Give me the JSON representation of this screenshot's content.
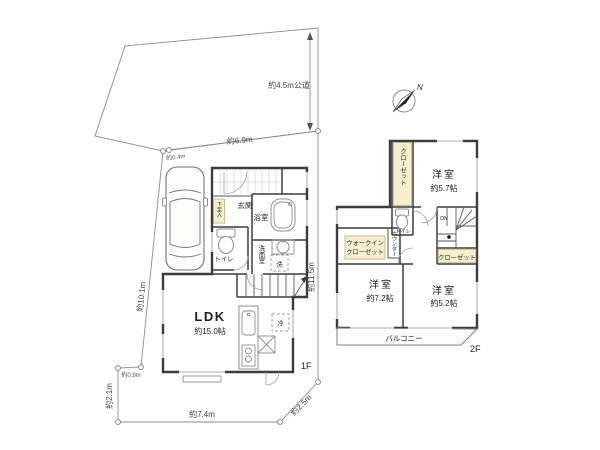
{
  "site": {
    "road_label": "約4.5m公道",
    "compass_n": "N",
    "dims": {
      "top": "約6.9m",
      "top_jog": "約0.4m",
      "left": "約10.1m",
      "bottom_jog": "約0.9m",
      "lower_left": "約2.1m",
      "bottom": "約7.4m",
      "bottom_right": "約2.5m",
      "right": "約11.5m"
    }
  },
  "floor1": {
    "tag": "1F",
    "entrance": "玄関",
    "shoe": "下足入",
    "toilet": "トイレ",
    "bath": "浴室",
    "washroom": "洗面室",
    "washer": "洗",
    "ldk": "LDK",
    "ldk_size": "約15.0帖",
    "fridge": "冷"
  },
  "floor2": {
    "tag": "2F",
    "closet_top": "クローゼット",
    "bedroom1": "洋室",
    "bedroom1_size": "約5.7帖",
    "toilet": "トイレ",
    "dn": "DN",
    "wic_line1": "ウォークイン",
    "wic_line2": "クローゼット",
    "counter": "カウンター",
    "closet_b": "クローゼット",
    "bedroom2": "洋室",
    "bedroom2_size": "約7.2帖",
    "bedroom3": "洋室",
    "bedroom3_size": "約5.2帖",
    "balcony": "バルコニー"
  },
  "colors": {
    "road": "#edf0ef",
    "lot": "#e8efe3",
    "room": "#faf7ef",
    "closet": "#f6efcf",
    "wall": "#3c3c3c"
  }
}
